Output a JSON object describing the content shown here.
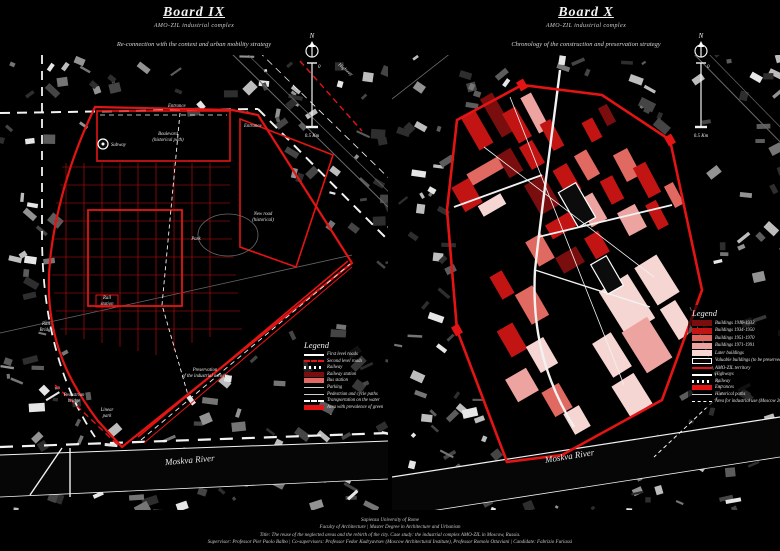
{
  "colors": {
    "bg": "#000000",
    "accent": "#c80e0e",
    "accent_bright": "#e41414",
    "b1916": "#7a0e0e",
    "b1934": "#c31414",
    "b1951": "#e06a62",
    "b1971": "#eda4a0",
    "blater": "#f6d6d2",
    "white": "#ffffff",
    "gray_building": "#9c9c9c"
  },
  "boards": [
    {
      "title": "Board IX",
      "subtitle": "AMO-ZIL industrial complex",
      "strategy": "Re-connection with the context and urban mobility strategy",
      "north": {
        "n": "N",
        "zero": "0",
        "half": "0.5 Km"
      },
      "labels": {
        "highway": "Highway",
        "entrance_a": "Entrance",
        "entrance_b": "Entrance",
        "boulevard_1": "Boulevard",
        "boulevard_2": "(historical path)",
        "subway": "Subway",
        "new_road_1": "New road",
        "new_road_2": "(historical)",
        "park": "Park",
        "rail_station_1": "Rail",
        "rail_station_2": "station",
        "rail_bridge_1": "Rail",
        "rail_bridge_2": "Bridge",
        "pedestrian_bridge_1": "Pedestrian",
        "pedestrian_bridge_2": "bridge",
        "linear_park_1": "Linear",
        "linear_park_2": "park",
        "preservation_1": "Preservation",
        "preservation_2": "of the industrial activity",
        "river": "Moskva River"
      },
      "legend": {
        "title": "Legend",
        "items": [
          {
            "label": "First level roads"
          },
          {
            "label": "Second level roads"
          },
          {
            "label": "Railway"
          },
          {
            "label": "Railway station"
          },
          {
            "label": "Bus station"
          },
          {
            "label": "Parking"
          },
          {
            "label": "Pedestrian and cycle paths"
          },
          {
            "label": "Transportation on the water"
          },
          {
            "label": "Area with prevalence of green"
          }
        ]
      }
    },
    {
      "title": "Board X",
      "subtitle": "AMO-ZIL industrial complex",
      "strategy": "Chronology of the construction and preservation strategy",
      "north": {
        "n": "N",
        "zero": "0",
        "half": "0.5 Km"
      },
      "labels": {
        "river": "Moskva River"
      },
      "legend": {
        "title": "Legend",
        "items": [
          {
            "label": "Buildings 1916-1933"
          },
          {
            "label": "Buildings 1934-1950"
          },
          {
            "label": "Buildings 1951-1970"
          },
          {
            "label": "Buildings 1971-1991"
          },
          {
            "label": "Later buildings"
          },
          {
            "label": "Valuable buildings (to be preserved)"
          },
          {
            "label": "AMO-ZIL territory"
          },
          {
            "label": "Highways"
          },
          {
            "label": "Railway"
          },
          {
            "label": "Entrances"
          },
          {
            "label": "Historical paths"
          },
          {
            "label": "Area for industrial use (Moscow 2025)"
          }
        ]
      }
    }
  ],
  "footer": {
    "line1": "Sapienza University of Rome",
    "line2": "Faculty of Architecture | Master Degree in Architecture and Urbanism",
    "line3": "Title:   The reuse of the neglected areas and the rebirth of the city. Case study: the industrial complex AMO-ZIL in Moscow, Russia.",
    "line4": "Supervisor: Professor Pier Paolo Balbo | Co-supervisors: Professor Fedor Kudryavtsev (Moscow Architectural Institute), Professor Romolo Ottaviani | Candidate: Fabrizio Furiassi"
  }
}
